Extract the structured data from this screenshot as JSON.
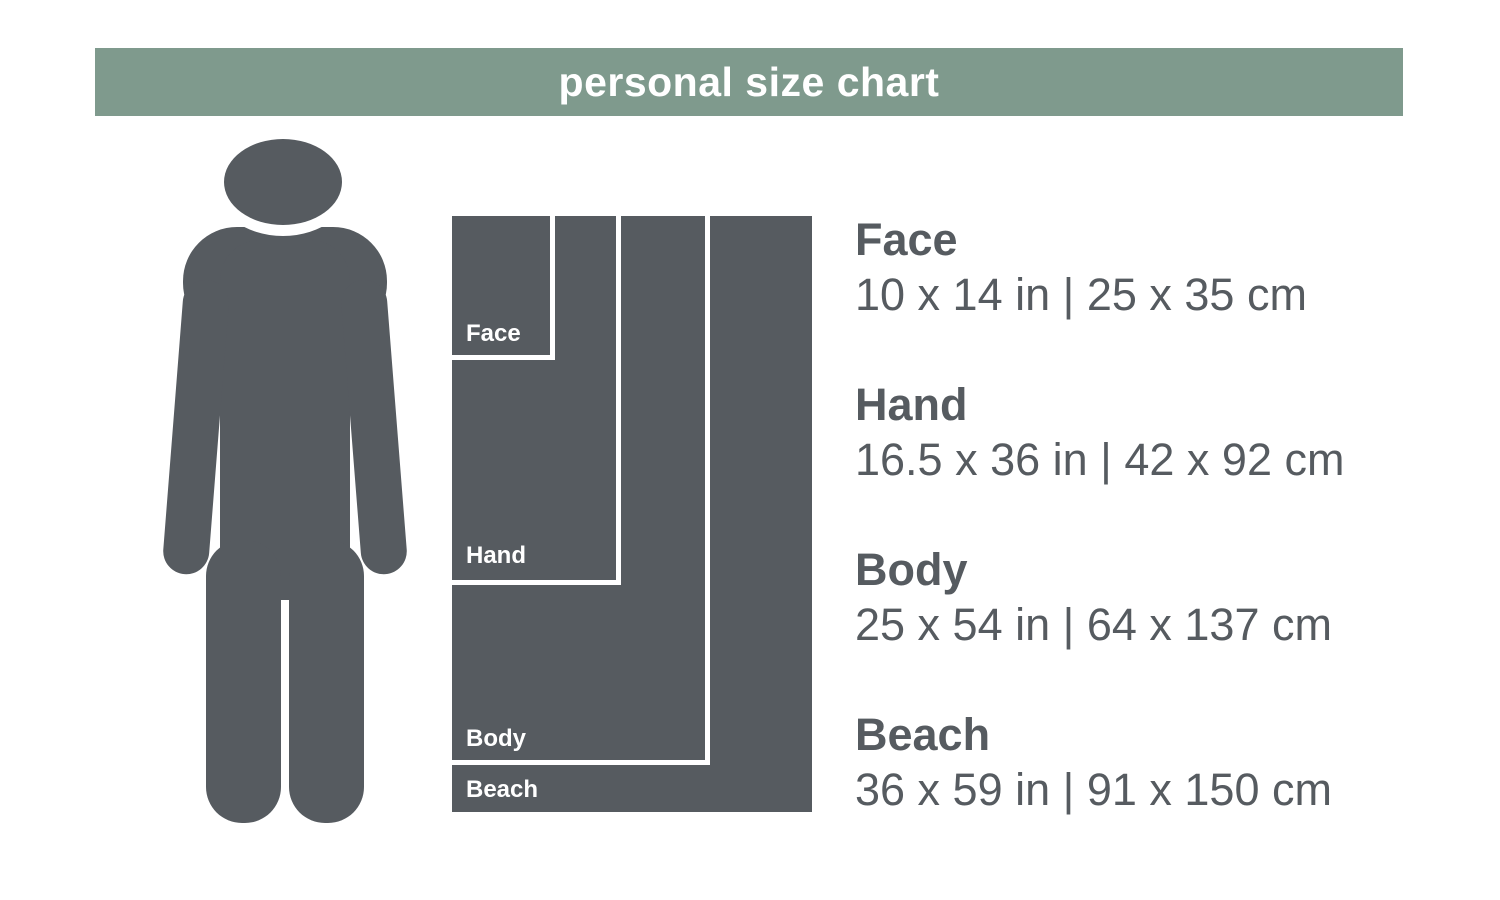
{
  "title": "personal size chart",
  "colors": {
    "header_bg": "#7f9a8d",
    "ink": "#565b60",
    "line": "#ffffff"
  },
  "person_icon": "person-silhouette",
  "sizes": [
    {
      "label": "Face",
      "inches": "10 x 14 in",
      "cm": "25 x 35 cm",
      "dims": "10 x 14 in | 25 x 35 cm"
    },
    {
      "label": "Hand",
      "inches": "16.5 x 36 in",
      "cm": "42 x 92 cm",
      "dims": "16.5 x 36 in | 42 x 92 cm"
    },
    {
      "label": "Body",
      "inches": "25 x 54 in",
      "cm": "64 x 137 cm",
      "dims": "25 x 54 in | 64 x 137 cm"
    },
    {
      "label": "Beach",
      "inches": "36 x 59 in",
      "cm": "91 x 150 cm",
      "dims": "36 x 59 in | 91 x 150 cm"
    }
  ],
  "chart_data": {
    "type": "table",
    "title": "personal size chart",
    "categories": [
      "Face",
      "Hand",
      "Body",
      "Beach"
    ],
    "series": [
      {
        "name": "width_in",
        "values": [
          10,
          16.5,
          25,
          36
        ]
      },
      {
        "name": "height_in",
        "values": [
          14,
          36,
          54,
          59
        ]
      },
      {
        "name": "width_cm",
        "values": [
          25,
          42,
          64,
          91
        ]
      },
      {
        "name": "height_cm",
        "values": [
          35,
          92,
          137,
          150
        ]
      }
    ],
    "scale_px_per_inch": 10.1
  }
}
